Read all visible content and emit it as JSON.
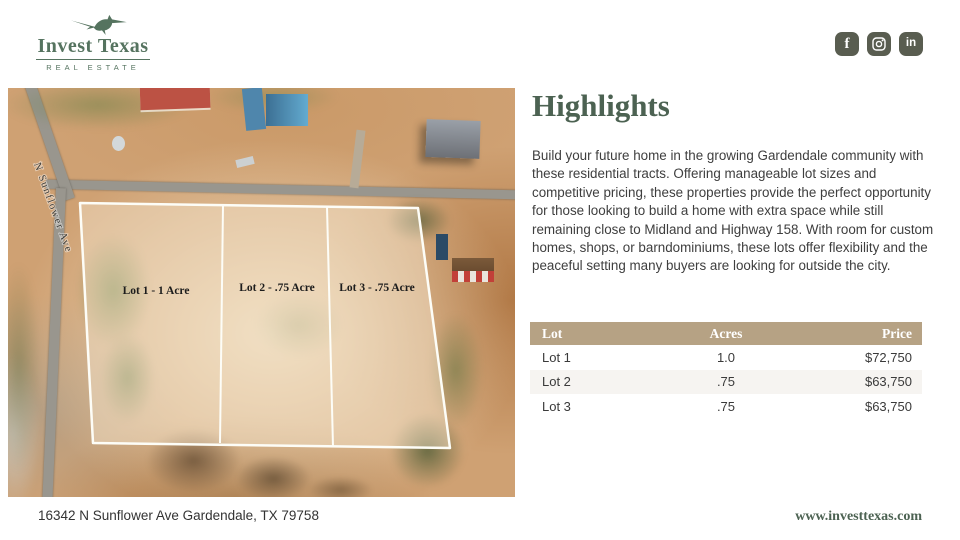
{
  "brand": {
    "name": "Invest Texas",
    "subtitle": "REAL ESTATE",
    "green": "#4c6252"
  },
  "social": {
    "facebook_glyph": "f",
    "linkedin_glyph": "in"
  },
  "photo": {
    "street_label": "N Sunflower Ave",
    "lot_labels": [
      "Lot 1 - 1 Acre",
      "Lot 2 - .75 Acre",
      "Lot 3 - .75 Acre"
    ]
  },
  "highlights": {
    "title": "Highlights",
    "body": "Build your future home in the growing Gardendale community with these residential tracts. Offering manageable lot sizes and competitive pricing, these properties provide the perfect opportunity for those looking to build a home with extra space while still remaining close to Midland and Highway 158. With room for custom homes, shops, or barndominiums, these lots offer flexibility and the peaceful setting many buyers are looking for outside the city."
  },
  "table": {
    "header_bg": "#b6a284",
    "headers": [
      "Lot",
      "Acres",
      "Price"
    ],
    "rows": [
      [
        "Lot 1",
        "1.0",
        "$72,750"
      ],
      [
        "Lot 2",
        ".75",
        "$63,750"
      ],
      [
        "Lot 3",
        ".75",
        "$63,750"
      ]
    ]
  },
  "footer": {
    "address": "16342 N Sunflower Ave Gardendale, TX 79758",
    "website": "www.investtexas.com"
  }
}
